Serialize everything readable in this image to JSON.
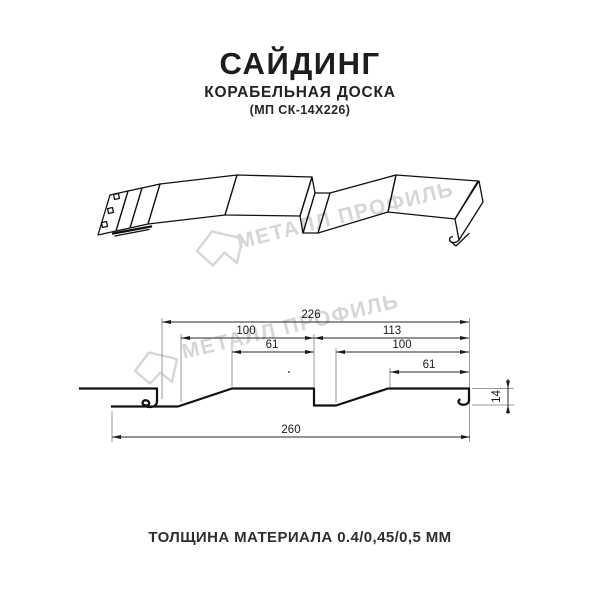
{
  "header": {
    "title": "САЙДИНГ",
    "subtitle": "КОРАБЕЛЬНАЯ ДОСКА",
    "model": "(МП СК-14Х226)"
  },
  "watermark": {
    "text": "МЕТАЛЛ ПРОФИЛЬ",
    "logo_icon": "metal-profil-logo",
    "color": "#d6d6d6"
  },
  "section": {
    "dims": {
      "d226": "226",
      "d100_left": "100",
      "d61_left": "61",
      "d113": "113",
      "d100_right": "100",
      "d61_right": "61",
      "d260": "260",
      "d14": "14"
    }
  },
  "footer": {
    "thickness": "ТОЛЩИНА МАТЕРИАЛА 0.4/0,45/0,5 ММ"
  },
  "colors": {
    "drawing_line": "#111111",
    "dimension_line": "#2a2a2a",
    "extension_line": "#9a9a9a",
    "watermark": "#d6d6d6",
    "text": "#1d1d1d",
    "background": "#ffffff"
  }
}
